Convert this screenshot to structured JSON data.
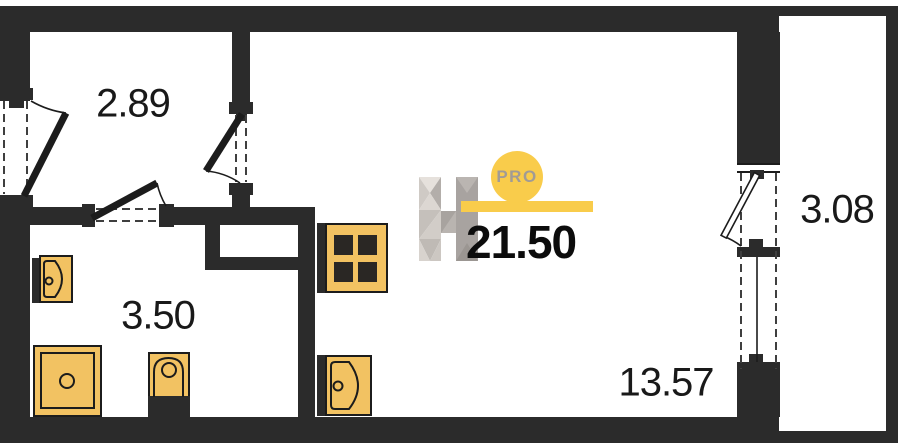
{
  "rooms": {
    "hallway": {
      "area": "2.89"
    },
    "bathroom": {
      "area": "3.50"
    },
    "living_room": {
      "area": "13.57"
    },
    "balcony": {
      "area": "3.08"
    }
  },
  "total_area": "21.50",
  "logo": {
    "badge": "PRO"
  },
  "fixtures": [
    "stove",
    "kitchen-sink",
    "washbasin",
    "shower",
    "toilet"
  ],
  "features": [
    "entry-door",
    "bathroom-door",
    "room-door",
    "balcony-door",
    "balcony-window",
    "vent-shaft"
  ],
  "colors": {
    "wall": "#2b2b2b",
    "fixture": "#f2c262",
    "outline": "#1c1c1c",
    "accent": "#f9cc4b",
    "text": "#191919"
  }
}
